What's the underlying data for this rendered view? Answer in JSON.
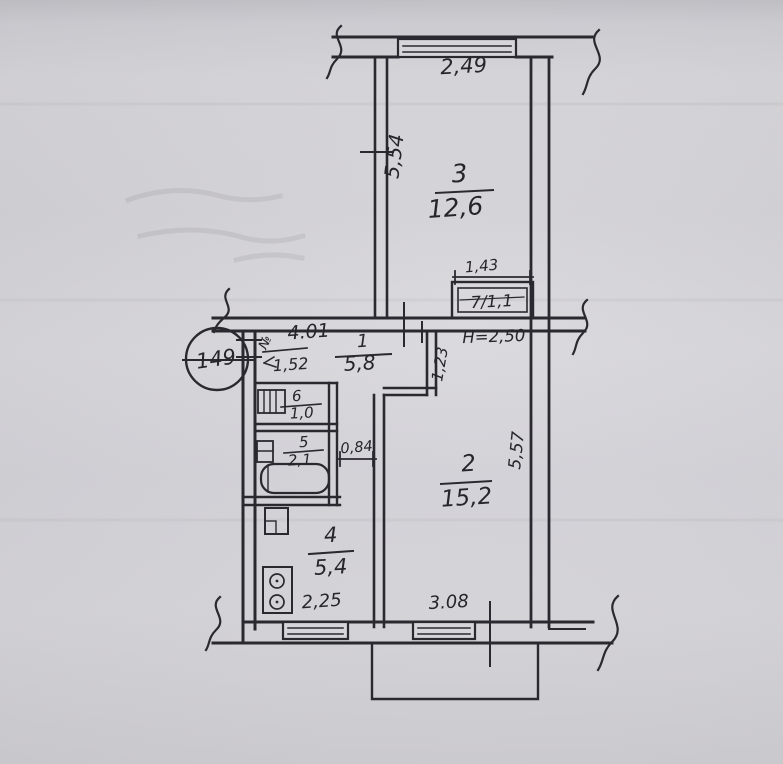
{
  "drawing": {
    "title": "hand-drawn apartment floor plan (BTI sketch)",
    "apartment_number": "149",
    "ceiling_height": "H=2,50",
    "corridor_mark": "№"
  },
  "rooms": {
    "room1_hall": {
      "number": "1",
      "area": "5,8"
    },
    "room2_living": {
      "number": "2",
      "area": "15,2"
    },
    "room3_bedroom": {
      "number": "3",
      "area": "12,6"
    },
    "room4_kitchen": {
      "number": "4",
      "area": "5,4"
    },
    "room5_bath": {
      "number": "5",
      "area": "2,1"
    },
    "room6_wc": {
      "number": "6",
      "area": "1,0"
    },
    "room7_closet": {
      "label": "7/1,1"
    }
  },
  "dimensions": {
    "window_top": "2,49",
    "wall_left_room3": "5,54",
    "closet": "1,43",
    "hallway": "4.01",
    "niche": "1,52",
    "wall_step": "1,23",
    "passage": "0,84",
    "wall_right_room2": "5,57",
    "window_kitchen": "2,25",
    "window_room2": "3.08"
  },
  "colors": {
    "ink": "#2a2930",
    "paper": "#d3d2d7"
  }
}
